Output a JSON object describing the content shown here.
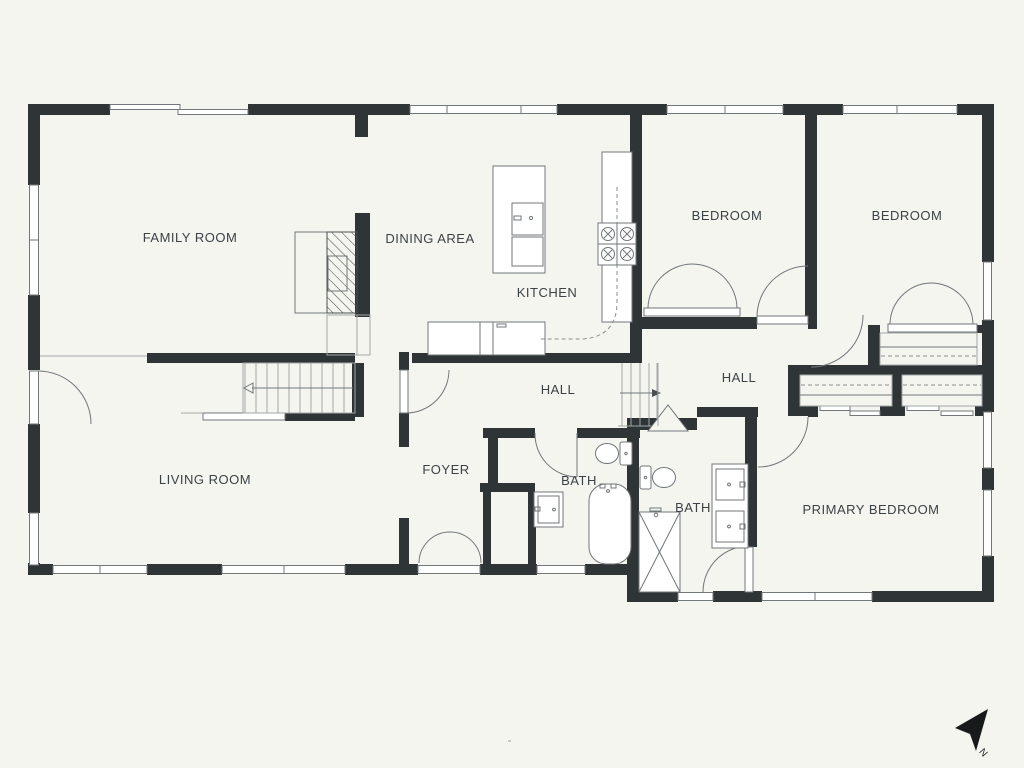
{
  "meta": {
    "background_color": "#f5f5ef",
    "wall_color": "#2f3437",
    "line_color": "#70767a",
    "label_color": "#3b4145"
  },
  "rooms": [
    {
      "id": "family-room",
      "label": "FAMILY ROOM"
    },
    {
      "id": "dining-area",
      "label": "DINING AREA"
    },
    {
      "id": "kitchen",
      "label": "KITCHEN"
    },
    {
      "id": "bedroom-1",
      "label": "BEDROOM"
    },
    {
      "id": "bedroom-2",
      "label": "BEDROOM"
    },
    {
      "id": "hall-1",
      "label": "HALL"
    },
    {
      "id": "hall-2",
      "label": "HALL"
    },
    {
      "id": "living-room",
      "label": "LIVING ROOM"
    },
    {
      "id": "foyer",
      "label": "FOYER"
    },
    {
      "id": "bath-1",
      "label": "BATH"
    },
    {
      "id": "bath-2",
      "label": "BATH"
    },
    {
      "id": "primary-bedroom",
      "label": "PRIMARY BEDROOM"
    }
  ],
  "compass": {
    "label": "N"
  }
}
